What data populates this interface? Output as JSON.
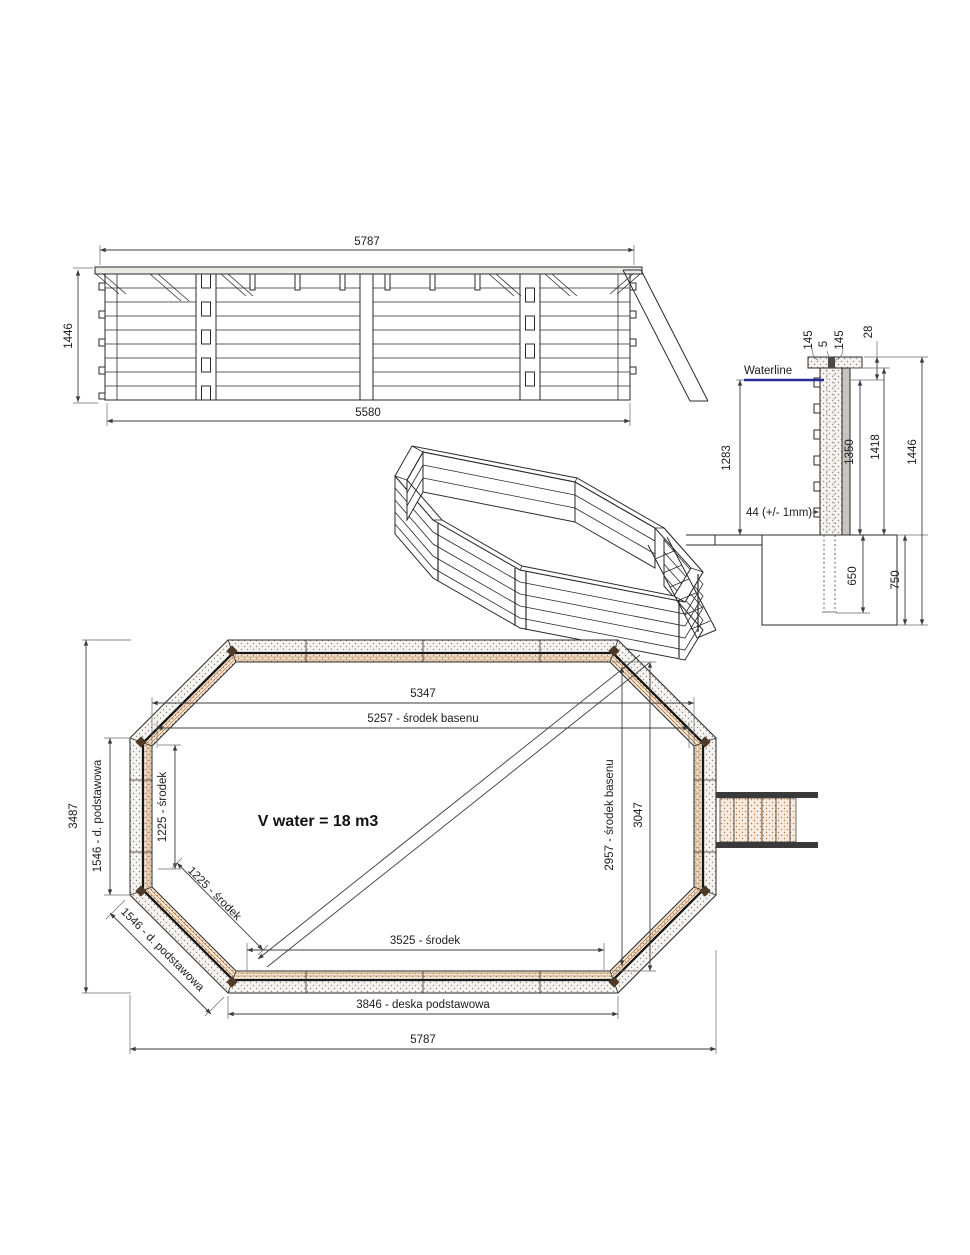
{
  "elevation": {
    "dim_top": "5787",
    "dim_left": "1446",
    "dim_bottom": "5580"
  },
  "section": {
    "cap_left": "145",
    "cap_gap": "5",
    "cap_right": "145",
    "cap_h": "28",
    "waterline": "Waterline",
    "depth": "1283",
    "board": "44 (+/- 1mm)",
    "wall": "1350",
    "h1418": "1418",
    "total": "1446",
    "post": "650",
    "footing": "750"
  },
  "plan": {
    "w_inner": "5347",
    "w_center": "5257 - środek basenu",
    "side_center": "1225 - środek",
    "corner_center": "1225 - środek",
    "side_base": "1546 - d. podstawowa",
    "corner_base": "1546 - d. podstawowa",
    "height": "3487",
    "volume": "V water = 18 m3",
    "right_center": "2957 - środek basenu",
    "right_inner": "3047",
    "bottom_center": "3525 - środek",
    "bottom_base": "3846 - deska podstawowa",
    "width": "5787"
  },
  "colors": {
    "waterline": "#2a2a96",
    "wood": "#bc7b42",
    "line": "#2a2a2a"
  }
}
